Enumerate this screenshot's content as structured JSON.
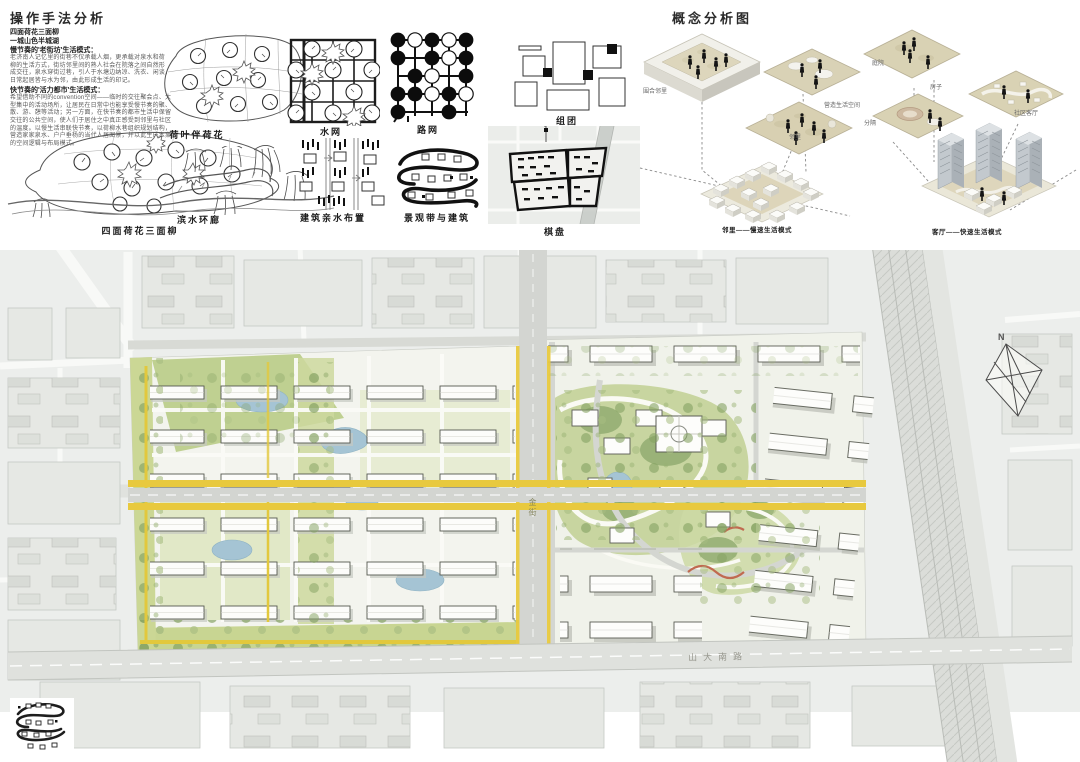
{
  "method_panel": {
    "title": "操作手法分析",
    "bold_lines": [
      "四面荷花三面柳",
      "一城山色半城湖",
      "慢节奏的'老街坊'生活模式："
    ],
    "para1": [
      "老济南人记忆里的街巷不仅承载人烟，更承载对泉水和荷",
      "柳的生活方式，街坊邻里间的熟人社会在院落之间自然形",
      "成交往，泉水穿街过巷，引人于水塘边纳凉、洗衣、闲谈，",
      "日常起居皆与水为邻，由此形成生活的印记。"
    ],
    "bold_line2": "快节奏的'活力都市'生活模式：",
    "para2": [
      "希望借助不同的convention空间——临时的交往聚会点、大",
      "型集中的活动场所，让居民在日常中也能享受慢节奏的聚、",
      "散、游、憩等活动；另一方面，在快节奏的都市生活中保留",
      "交往的公共空间，使人们于居住之中真正感受到邻里与社区",
      "的温度。以慢生活串联快节奏，以荷柳水巷组织规划结构，",
      "营造家家泉水、户户垂杨的当代人居图景，并以此生成本案",
      "的空间逻辑与布局模式。"
    ],
    "sketches": [
      {
        "caption": "四面荷花三面柳"
      },
      {
        "caption": "荷叶伴荷花"
      },
      {
        "caption": "滨水环廊"
      },
      {
        "caption": "水网"
      },
      {
        "caption": "路网"
      },
      {
        "caption": "建筑亲水布置"
      },
      {
        "caption": "景观带与建筑"
      },
      {
        "caption": "组团"
      },
      {
        "caption": "棋盘"
      }
    ]
  },
  "concept_panel": {
    "title": "概念分析图",
    "tray_label": "围合邻里",
    "mid_plate_label": "邻里",
    "space_label": "营造生活空间",
    "courtyard_caption": "邻里——慢速生活模式",
    "roof_label": "庭院",
    "house_label": "房子",
    "divide_label": "分隔",
    "community_label": "社区客厅",
    "towers_caption": "客厅——快速生活模式"
  },
  "site_plan": {
    "vertical_road_label": "金街",
    "south_road_label": "山大南路",
    "north_label": "N",
    "colors": {
      "road_yellow": "#e8c93e",
      "water": "#a5c4d4",
      "green": "#c3d298",
      "green_dark": "#93ad72",
      "context_bg": "#ecefec",
      "building_white": "#fcfcfa"
    }
  }
}
